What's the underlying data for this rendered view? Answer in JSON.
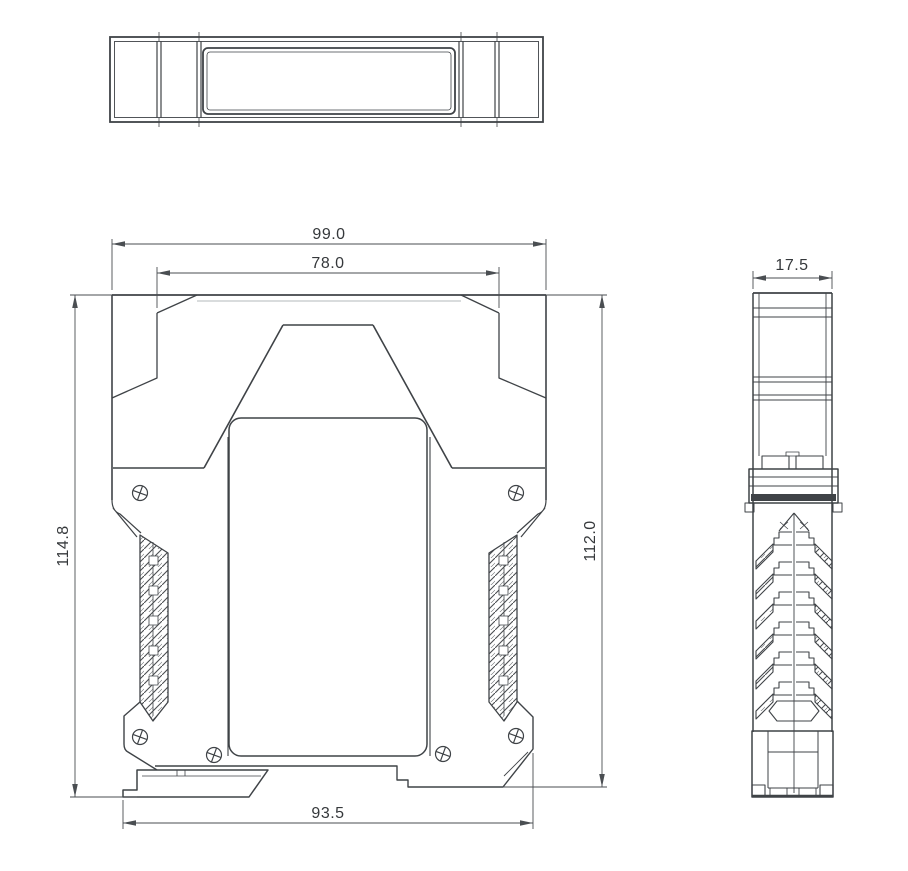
{
  "drawing": {
    "dimensions": {
      "overall_width": "99.0",
      "cap_width": "78.0",
      "overall_height": "114.8",
      "body_height": "112.0",
      "bottom_width": "93.5",
      "depth": "17.5"
    },
    "colors": {
      "line": "#3f4347",
      "background": "#ffffff"
    }
  }
}
